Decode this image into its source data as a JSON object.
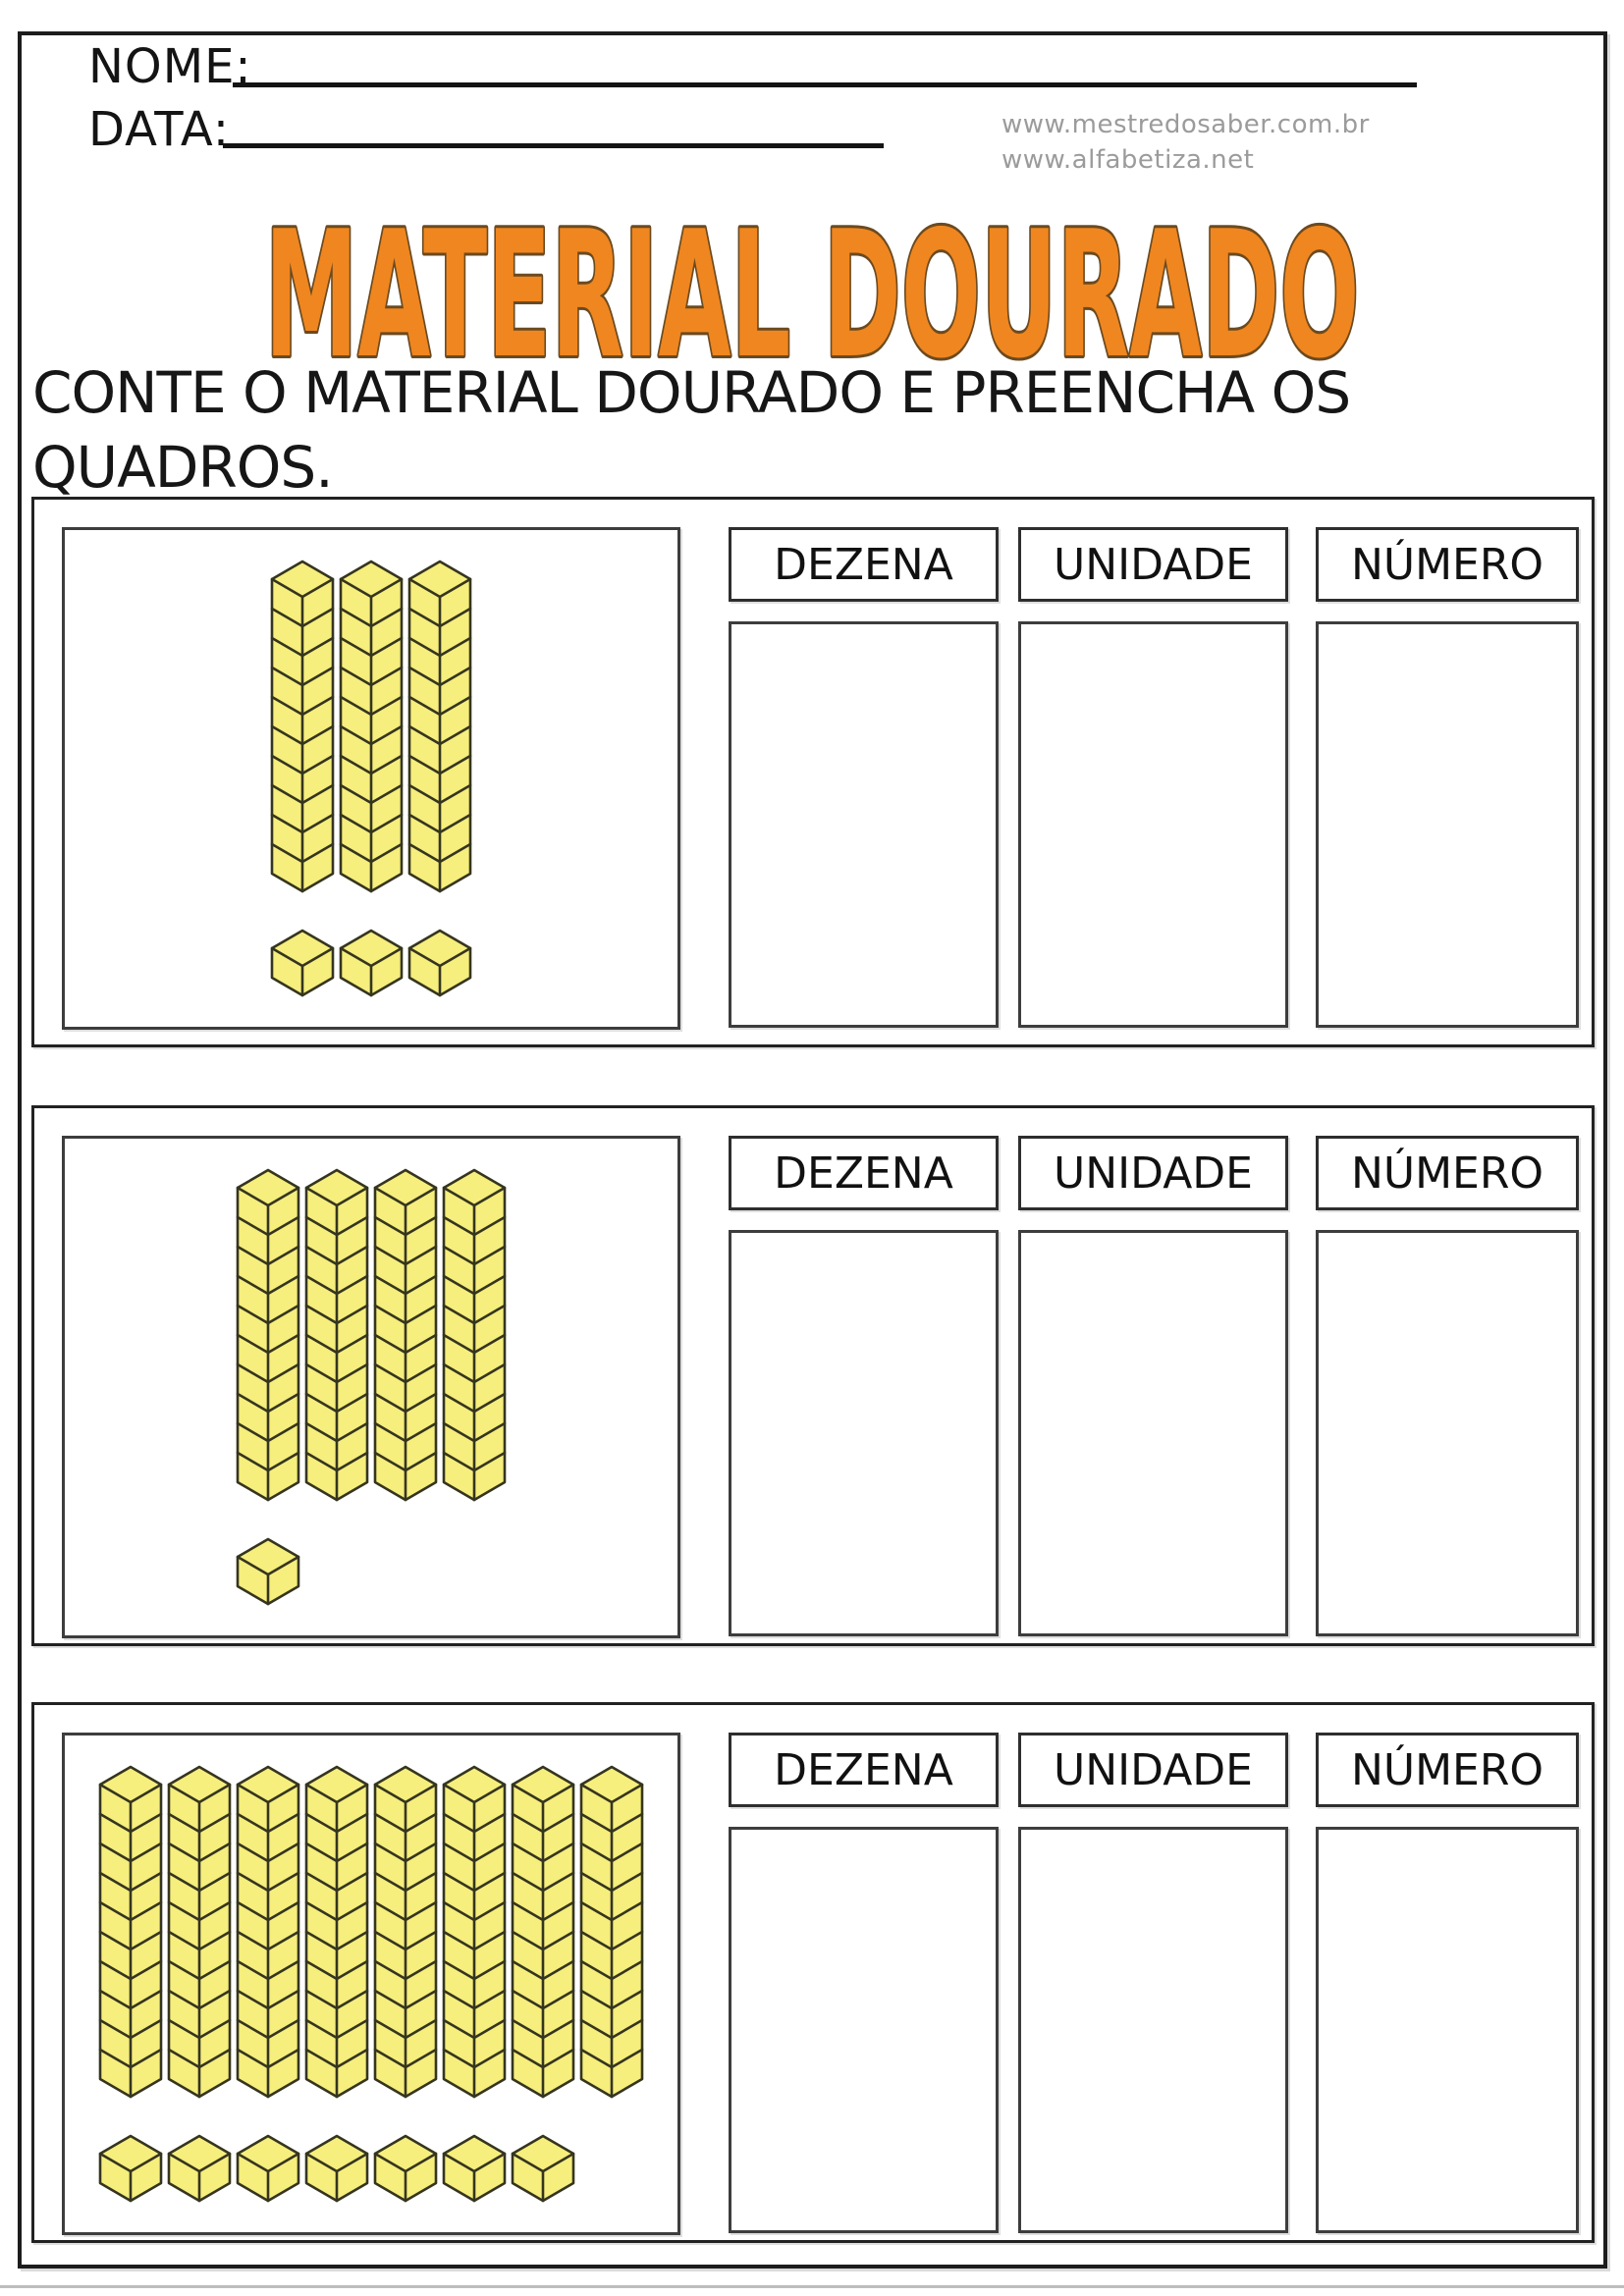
{
  "header": {
    "name_label": "NOME:",
    "date_label": "DATA:",
    "websites": [
      "www.mestredosaber.com.br",
      "www.alfabetiza.net"
    ],
    "title": "MATERIAL DOURADO"
  },
  "instruction": {
    "line1": "CONTE O MATERIAL DOURADO E PREENCHA OS",
    "line2": "QUADROS."
  },
  "columns": {
    "dezena": "DEZENA",
    "unidade": "UNIDADE",
    "numero": "NÚMERO"
  },
  "sections": [
    {
      "blocks": {
        "tens_rods": 3,
        "unit_cubes": 3
      },
      "answers": {
        "dezena": "",
        "unidade": "",
        "numero": ""
      }
    },
    {
      "blocks": {
        "tens_rods": 4,
        "unit_cubes": 1
      },
      "answers": {
        "dezena": "",
        "unidade": "",
        "numero": ""
      }
    },
    {
      "blocks": {
        "tens_rods": 8,
        "unit_cubes": 7
      },
      "answers": {
        "dezena": "",
        "unidade": "",
        "numero": ""
      }
    }
  ],
  "colors": {
    "title_orange": "#F0861F",
    "title_outline": "#6B4A20",
    "block_fill": "#F6EE7D",
    "block_stroke": "#35351F",
    "url_gray": "#9B9B9B"
  }
}
